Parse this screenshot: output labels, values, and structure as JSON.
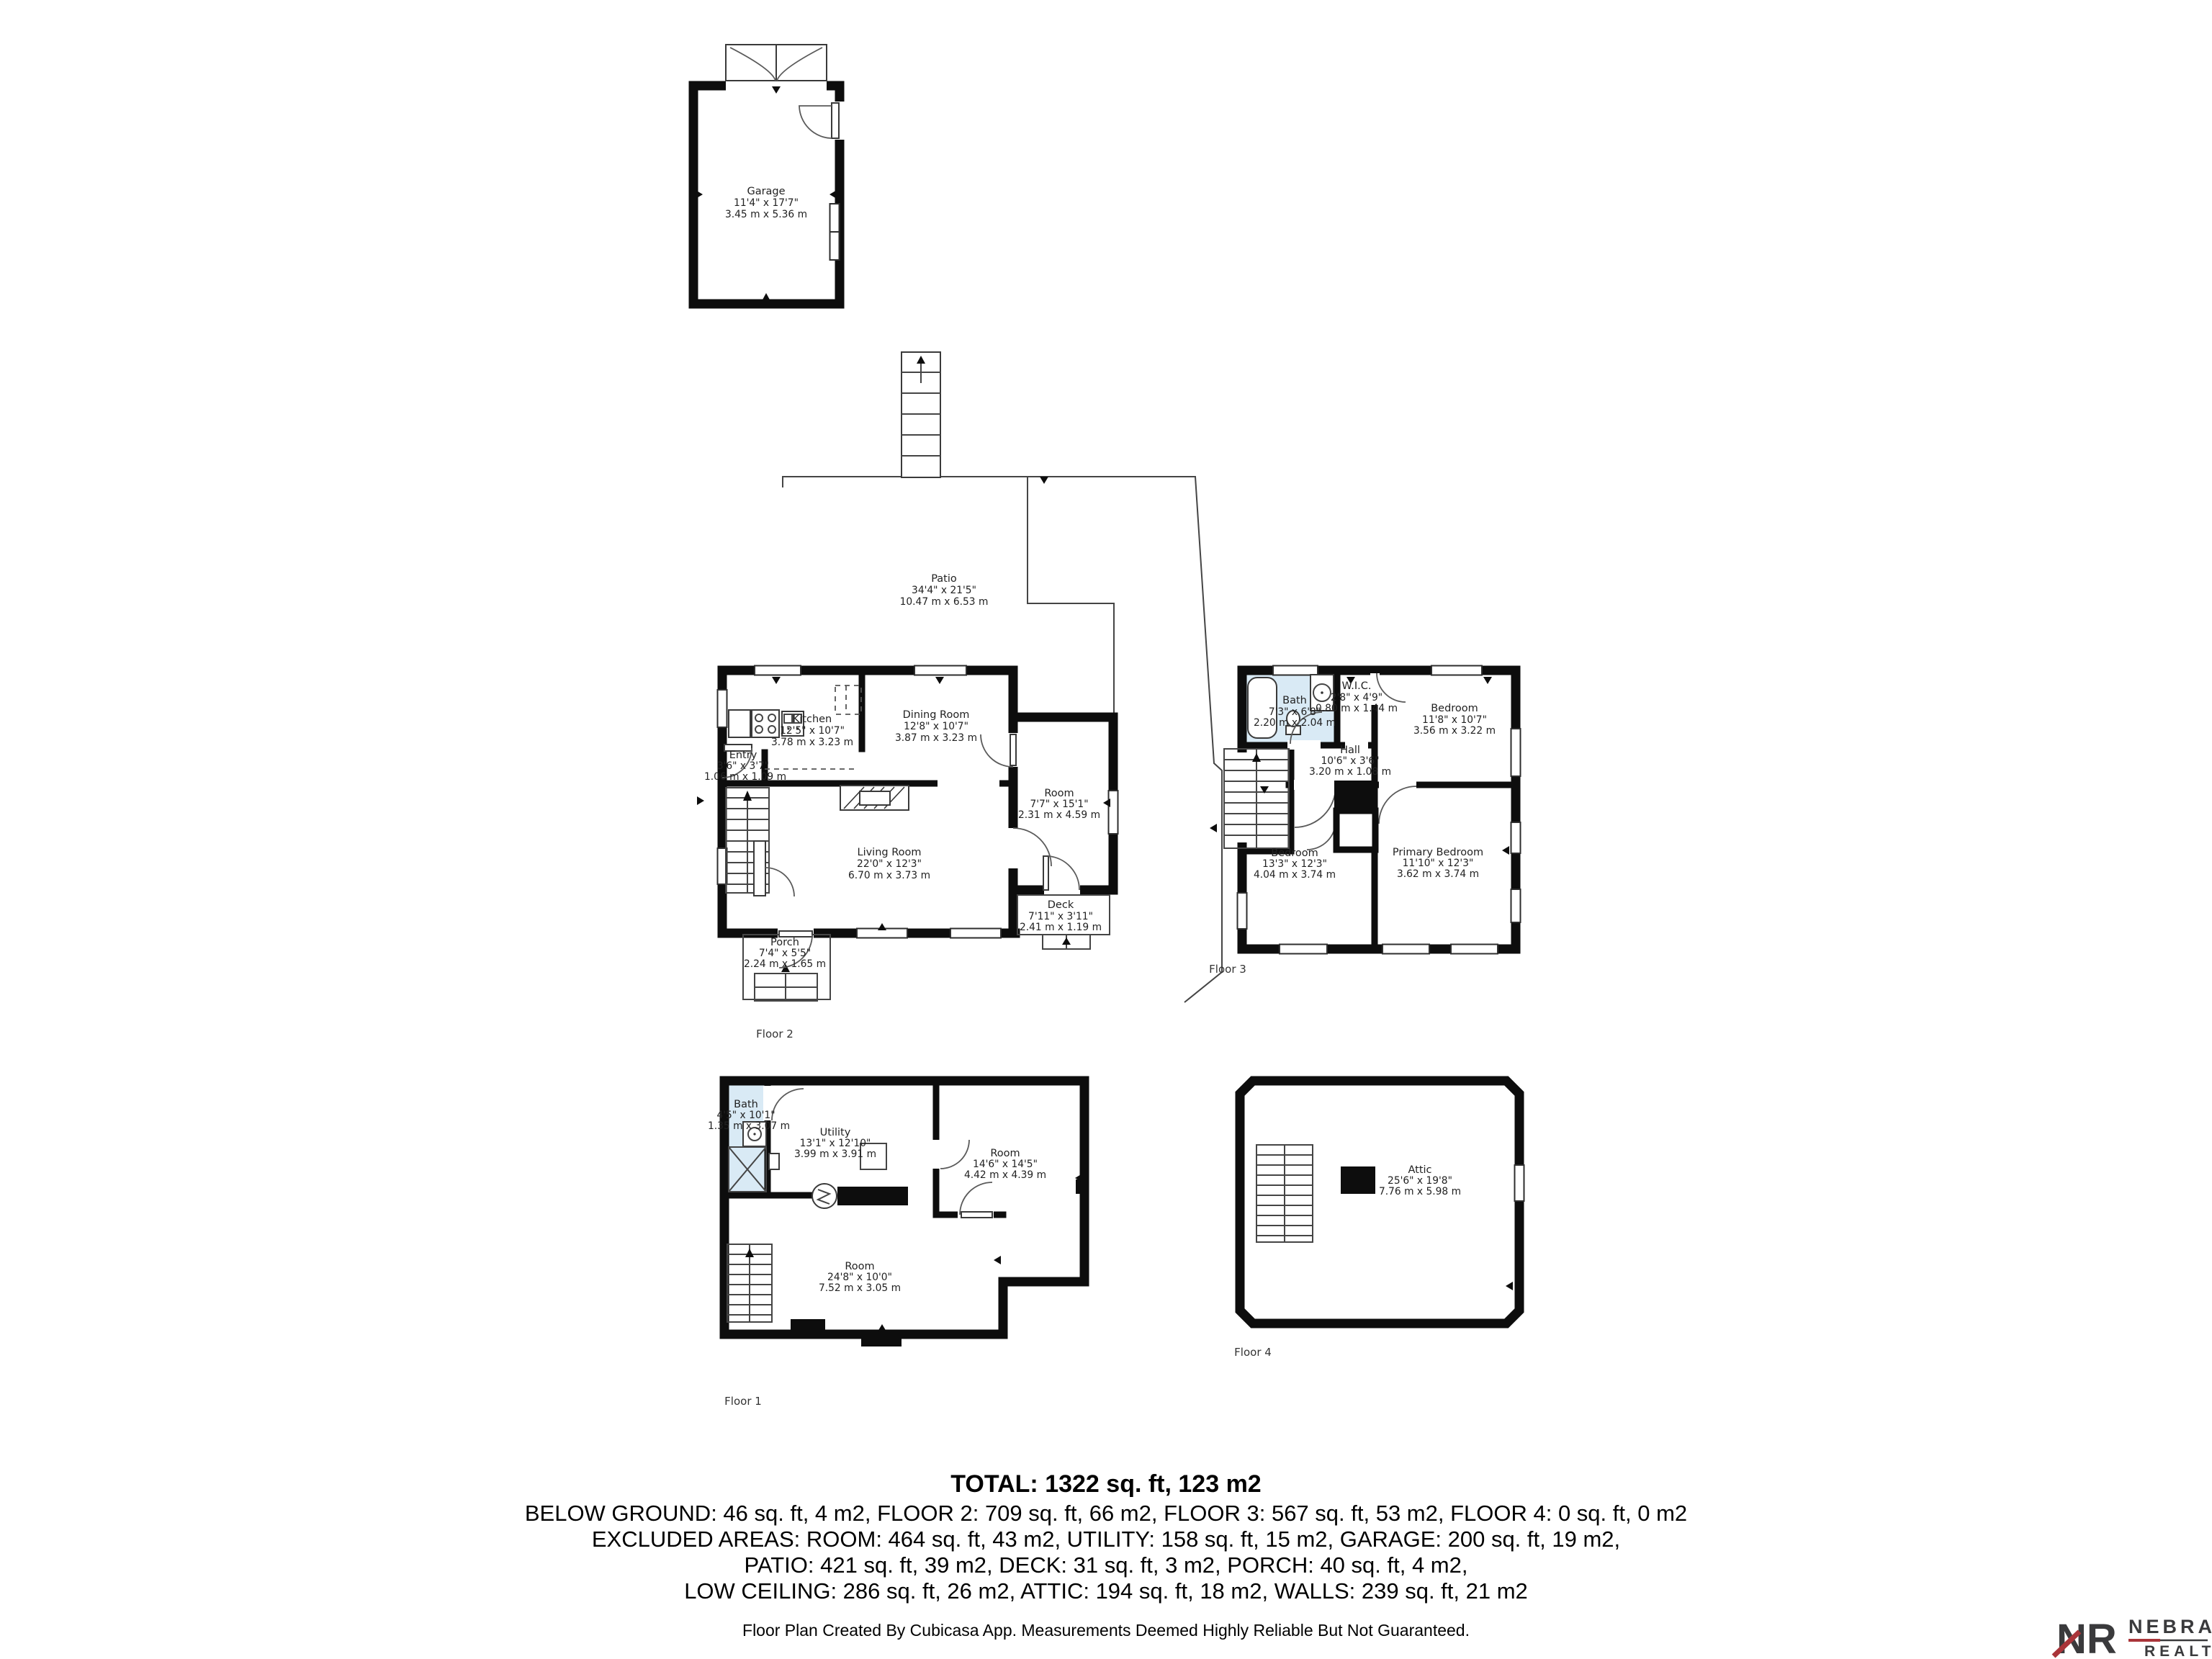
{
  "plan": {
    "garage": {
      "name": "Garage",
      "imp": "11'4\" x 17'7\"",
      "met": "3.45 m x 5.36 m"
    },
    "patio": {
      "name": "Patio",
      "imp": "34'4\" x 21'5\"",
      "met": "10.47 m x 6.53 m"
    },
    "floor2": {
      "caption": "Floor 2",
      "kitchen": {
        "name": "Kitchen",
        "imp": "12'5\" x 10'7\"",
        "met": "3.78 m x 3.23 m"
      },
      "dining": {
        "name": "Dining Room",
        "imp": "12'8\" x 10'7\"",
        "met": "3.87 m x 3.23 m"
      },
      "entry": {
        "name": "Entry",
        "imp": "3'6\" x 3'7\"",
        "met": "1.06 m x 1.09 m"
      },
      "living": {
        "name": "Living Room",
        "imp": "22'0\" x 12'3\"",
        "met": "6.70 m x 3.73 m"
      },
      "room": {
        "name": "Room",
        "imp": "7'7\" x 15'1\"",
        "met": "2.31 m x 4.59 m"
      },
      "deck": {
        "name": "Deck",
        "imp": "7'11\" x 3'11\"",
        "met": "2.41 m x 1.19 m"
      },
      "porch": {
        "name": "Porch",
        "imp": "7'4\" x 5'5\"",
        "met": "2.24 m x 1.65 m"
      }
    },
    "floor3": {
      "caption": "Floor 3",
      "bath": {
        "name": "Bath",
        "imp": "7'3\" x 6'8\"",
        "met": "2.20 m x 2.04 m"
      },
      "wic": {
        "name": "W.I.C.",
        "imp": "2'8\" x 4'9\"",
        "met": "0.80 m x 1.44 m"
      },
      "bedroom_top": {
        "name": "Bedroom",
        "imp": "11'8\" x 10'7\"",
        "met": "3.56 m x 3.22 m"
      },
      "hall": {
        "name": "Hall",
        "imp": "10'6\" x 3'6\"",
        "met": "3.20 m x 1.08 m"
      },
      "bedroom": {
        "name": "Bedroom",
        "imp": "13'3\" x 12'3\"",
        "met": "4.04 m x 3.74 m"
      },
      "primary": {
        "name": "Primary Bedroom",
        "imp": "11'10\" x 12'3\"",
        "met": "3.62 m x 3.74 m"
      }
    },
    "floor1": {
      "caption": "Floor 1",
      "bath": {
        "name": "Bath",
        "imp": "4'5\" x 10'1\"",
        "met": "1.35 m x 3.07 m"
      },
      "utility": {
        "name": "Utility",
        "imp": "13'1\" x 12'10\"",
        "met": "3.99 m x 3.91 m"
      },
      "room_right": {
        "name": "Room",
        "imp": "14'6\" x 14'5\"",
        "met": "4.42 m x 4.39 m"
      },
      "room_bottom": {
        "name": "Room",
        "imp": "24'8\" x 10'0\"",
        "met": "7.52 m x 3.05 m"
      }
    },
    "floor4": {
      "caption": "Floor 4",
      "attic": {
        "name": "Attic",
        "imp": "25'6\" x 19'8\"",
        "met": "7.76 m x 5.98 m"
      }
    }
  },
  "summary": {
    "total": "TOTAL: 1322 sq. ft, 123 m2",
    "below": "BELOW GROUND: 46 sq. ft, 4 m2, FLOOR 2: 709 sq. ft, 66 m2, FLOOR 3: 567 sq. ft, 53 m2, FLOOR 4: 0 sq. ft, 0 m2",
    "excluded": "EXCLUDED AREAS: ROOM: 464 sq. ft, 43 m2, UTILITY: 158 sq. ft, 15 m2, GARAGE: 200 sq. ft, 19 m2,",
    "patio_line": "PATIO: 421 sq. ft, 39 m2, DECK: 31 sq. ft, 3 m2, PORCH: 40 sq. ft, 4 m2,",
    "low_line": "LOW CEILING: 286 sq. ft, 26 m2, ATTIC: 194 sq. ft, 18 m2, WALLS: 239 sq. ft, 21 m2"
  },
  "footer": {
    "text": "Floor Plan Created By Cubicasa App. Measurements Deemed Highly Reliable But Not Guaranteed."
  },
  "logo": {
    "monogram": "NR",
    "brand": "NEBRASKA",
    "sub": "REALTY",
    "accent_red": "#A93439",
    "dark": "#3A3A3C"
  },
  "colors": {
    "walls": "#0d0d0d",
    "bath_fill": "#D9EAF5"
  }
}
